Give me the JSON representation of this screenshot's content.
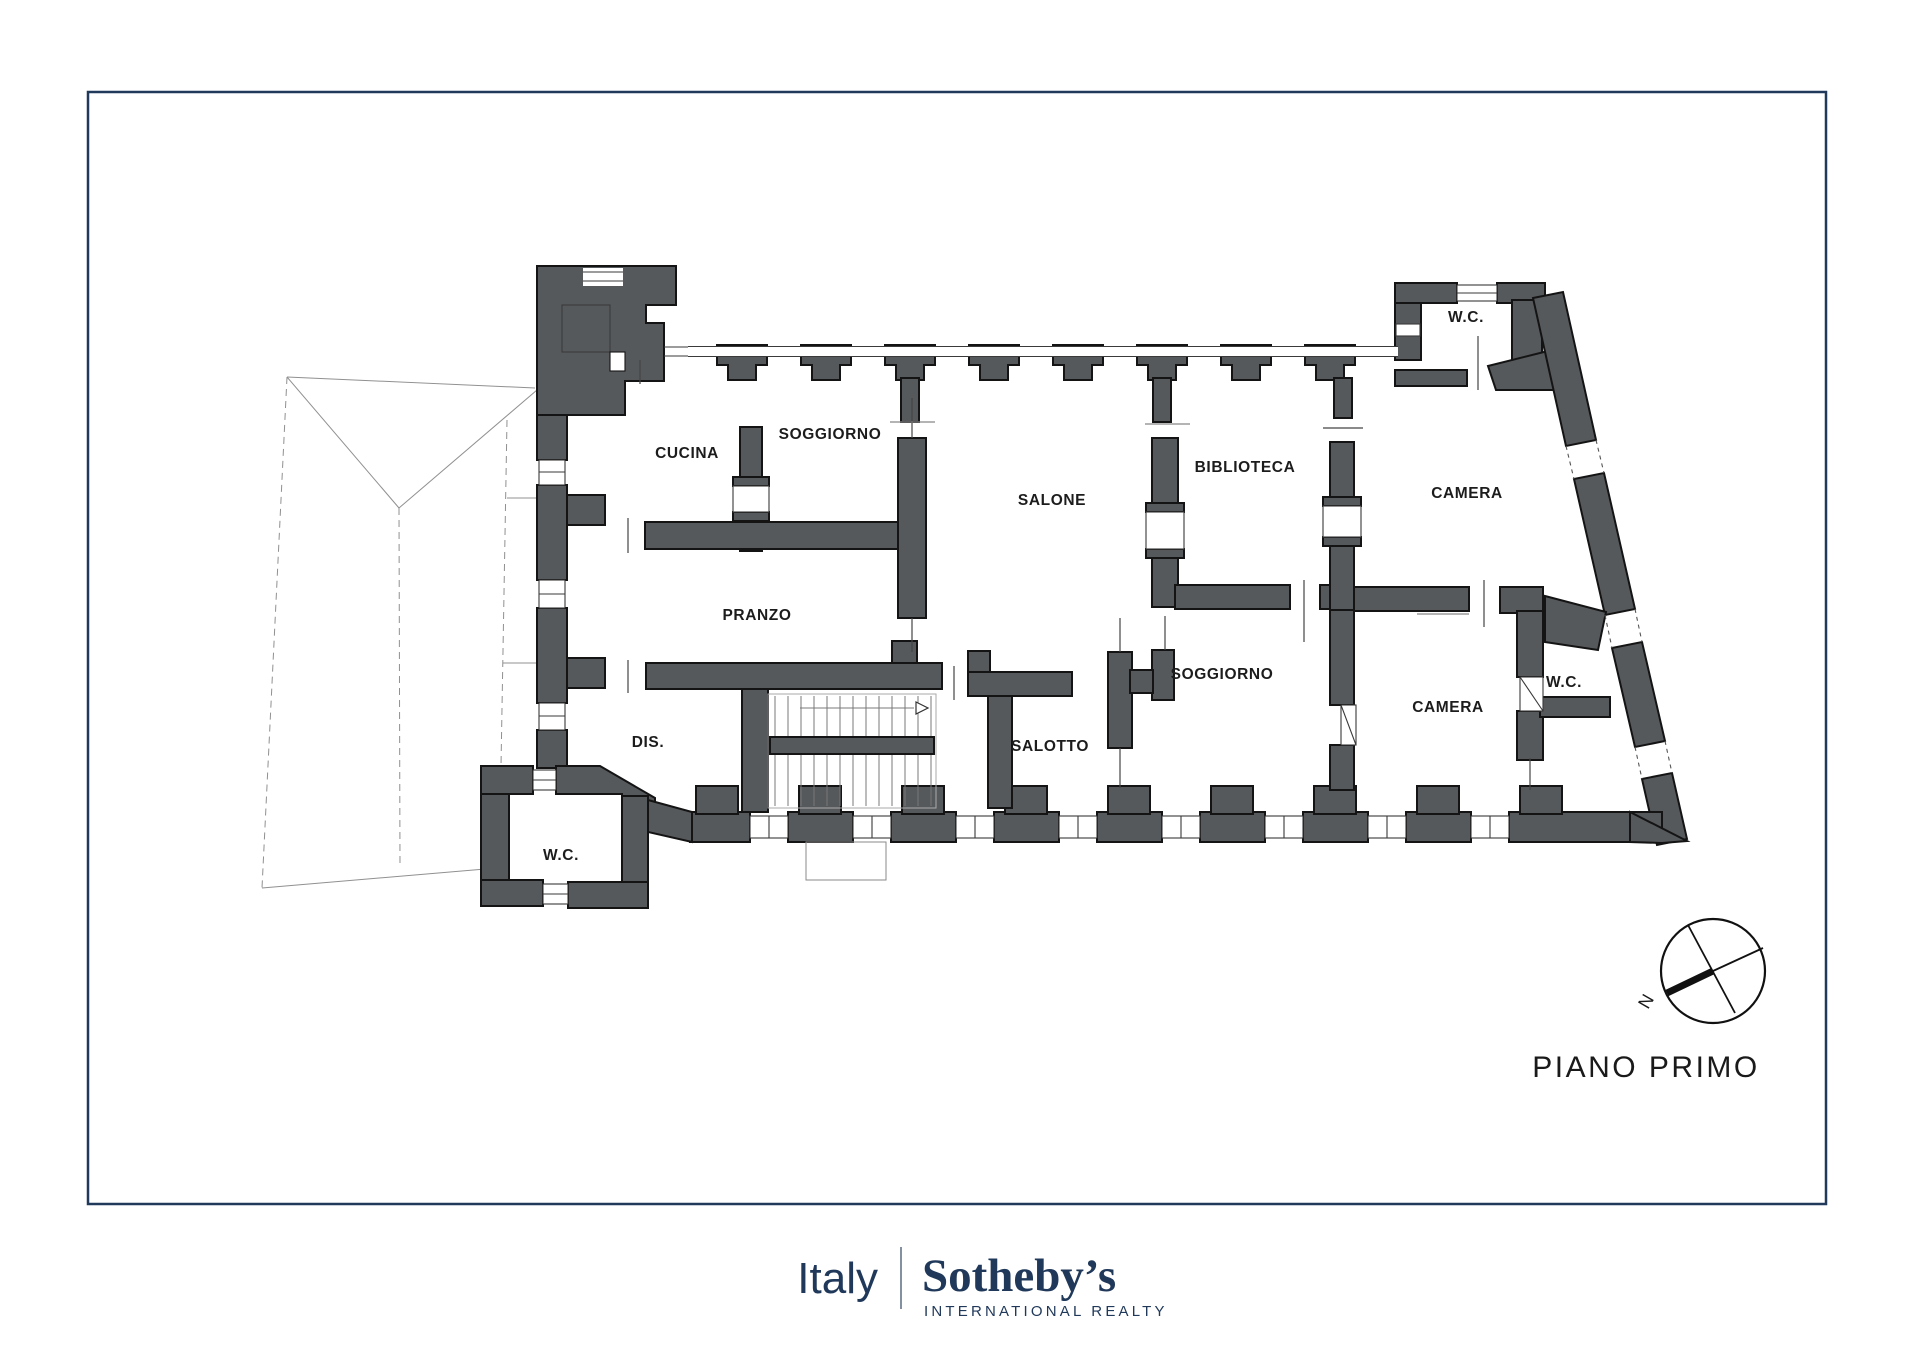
{
  "plan": {
    "rooms": {
      "wc_north": "W.C.",
      "cucina": "CUCINA",
      "soggiorno_north": "SOGGIORNO",
      "salone": "SALONE",
      "biblioteca": "BIBLIOTECA",
      "camera_north": "CAMERA",
      "pranzo": "PRANZO",
      "dis": "DIS.",
      "salotto": "SALOTTO",
      "soggiorno_south": "SOGGIORNO",
      "camera_south": "CAMERA",
      "wc_south": "W.C.",
      "wc_west": "W.C."
    },
    "floor_label": "PIANO PRIMO",
    "compass_north_label": "N"
  },
  "footer": {
    "country": "Italy",
    "brand": "Sotheby’s",
    "brand_sub": "INTERNATIONAL REALTY"
  },
  "colors": {
    "wall": "#56595c",
    "outline": "#141414",
    "brand_navy": "#20395a",
    "border_navy": "#21395a"
  }
}
